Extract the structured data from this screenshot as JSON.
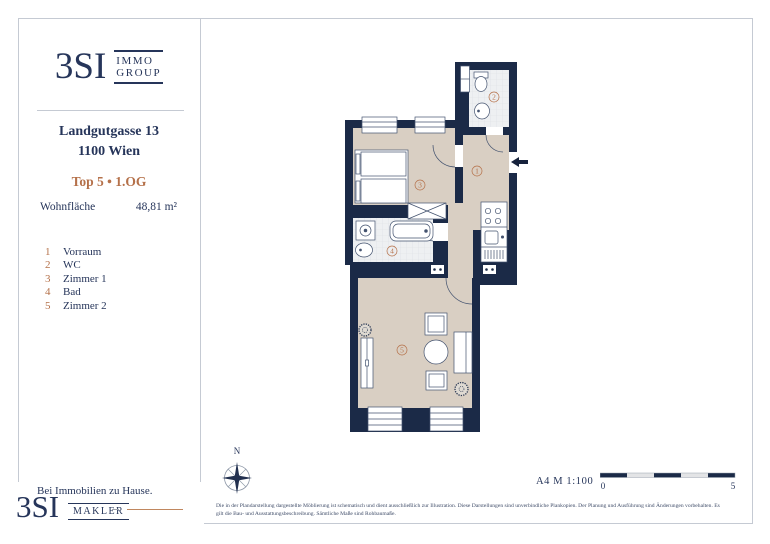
{
  "colors": {
    "navy_wall": "#1b2a47",
    "navy_text": "#26355a",
    "orange": "#b5714a",
    "beige_floor": "#d9cfc3",
    "tile_floor": "#eef0f2",
    "frame_gray": "#c5cad3"
  },
  "brand": {
    "logo_main": "3SI",
    "logo_top": "IMMO",
    "logo_bottom": "GROUP"
  },
  "property": {
    "address_line1": "Landgutgasse 13",
    "address_line2": "1100 Wien",
    "unit_line": "Top 5 • 1.OG",
    "area_label": "Wohnfläche",
    "area_value": "48,81 m²"
  },
  "legend": {
    "items": [
      {
        "num": "1",
        "label": "Vorraum"
      },
      {
        "num": "2",
        "label": "WC"
      },
      {
        "num": "3",
        "label": "Zimmer 1"
      },
      {
        "num": "4",
        "label": "Bad"
      },
      {
        "num": "5",
        "label": "Zimmer 2"
      }
    ]
  },
  "plan": {
    "room_labels": [
      "1",
      "2",
      "3",
      "4",
      "5"
    ],
    "compass_label": "N",
    "paper_scale": "A4 M 1:100",
    "scalebar": {
      "start": "0",
      "end": "5"
    }
  },
  "footer": {
    "tagline": "Bei Immobilien zu Hause.",
    "logo_main": "3SI",
    "logo_sub": "MAKLER",
    "disclaimer_line1": "Die in der Plandarstellung dargestellte Möblierung ist schematisch und dient ausschließlich zur Illustration. Diese Darstellungen sind unverbindliche Plankopien. Der Planung und Ausführung sind Änderungen vorbehalten. Es",
    "disclaimer_line2": "gilt die Bau- und Ausstattungsbeschreibung. Sämtliche Maße sind Rohbaumaße."
  }
}
